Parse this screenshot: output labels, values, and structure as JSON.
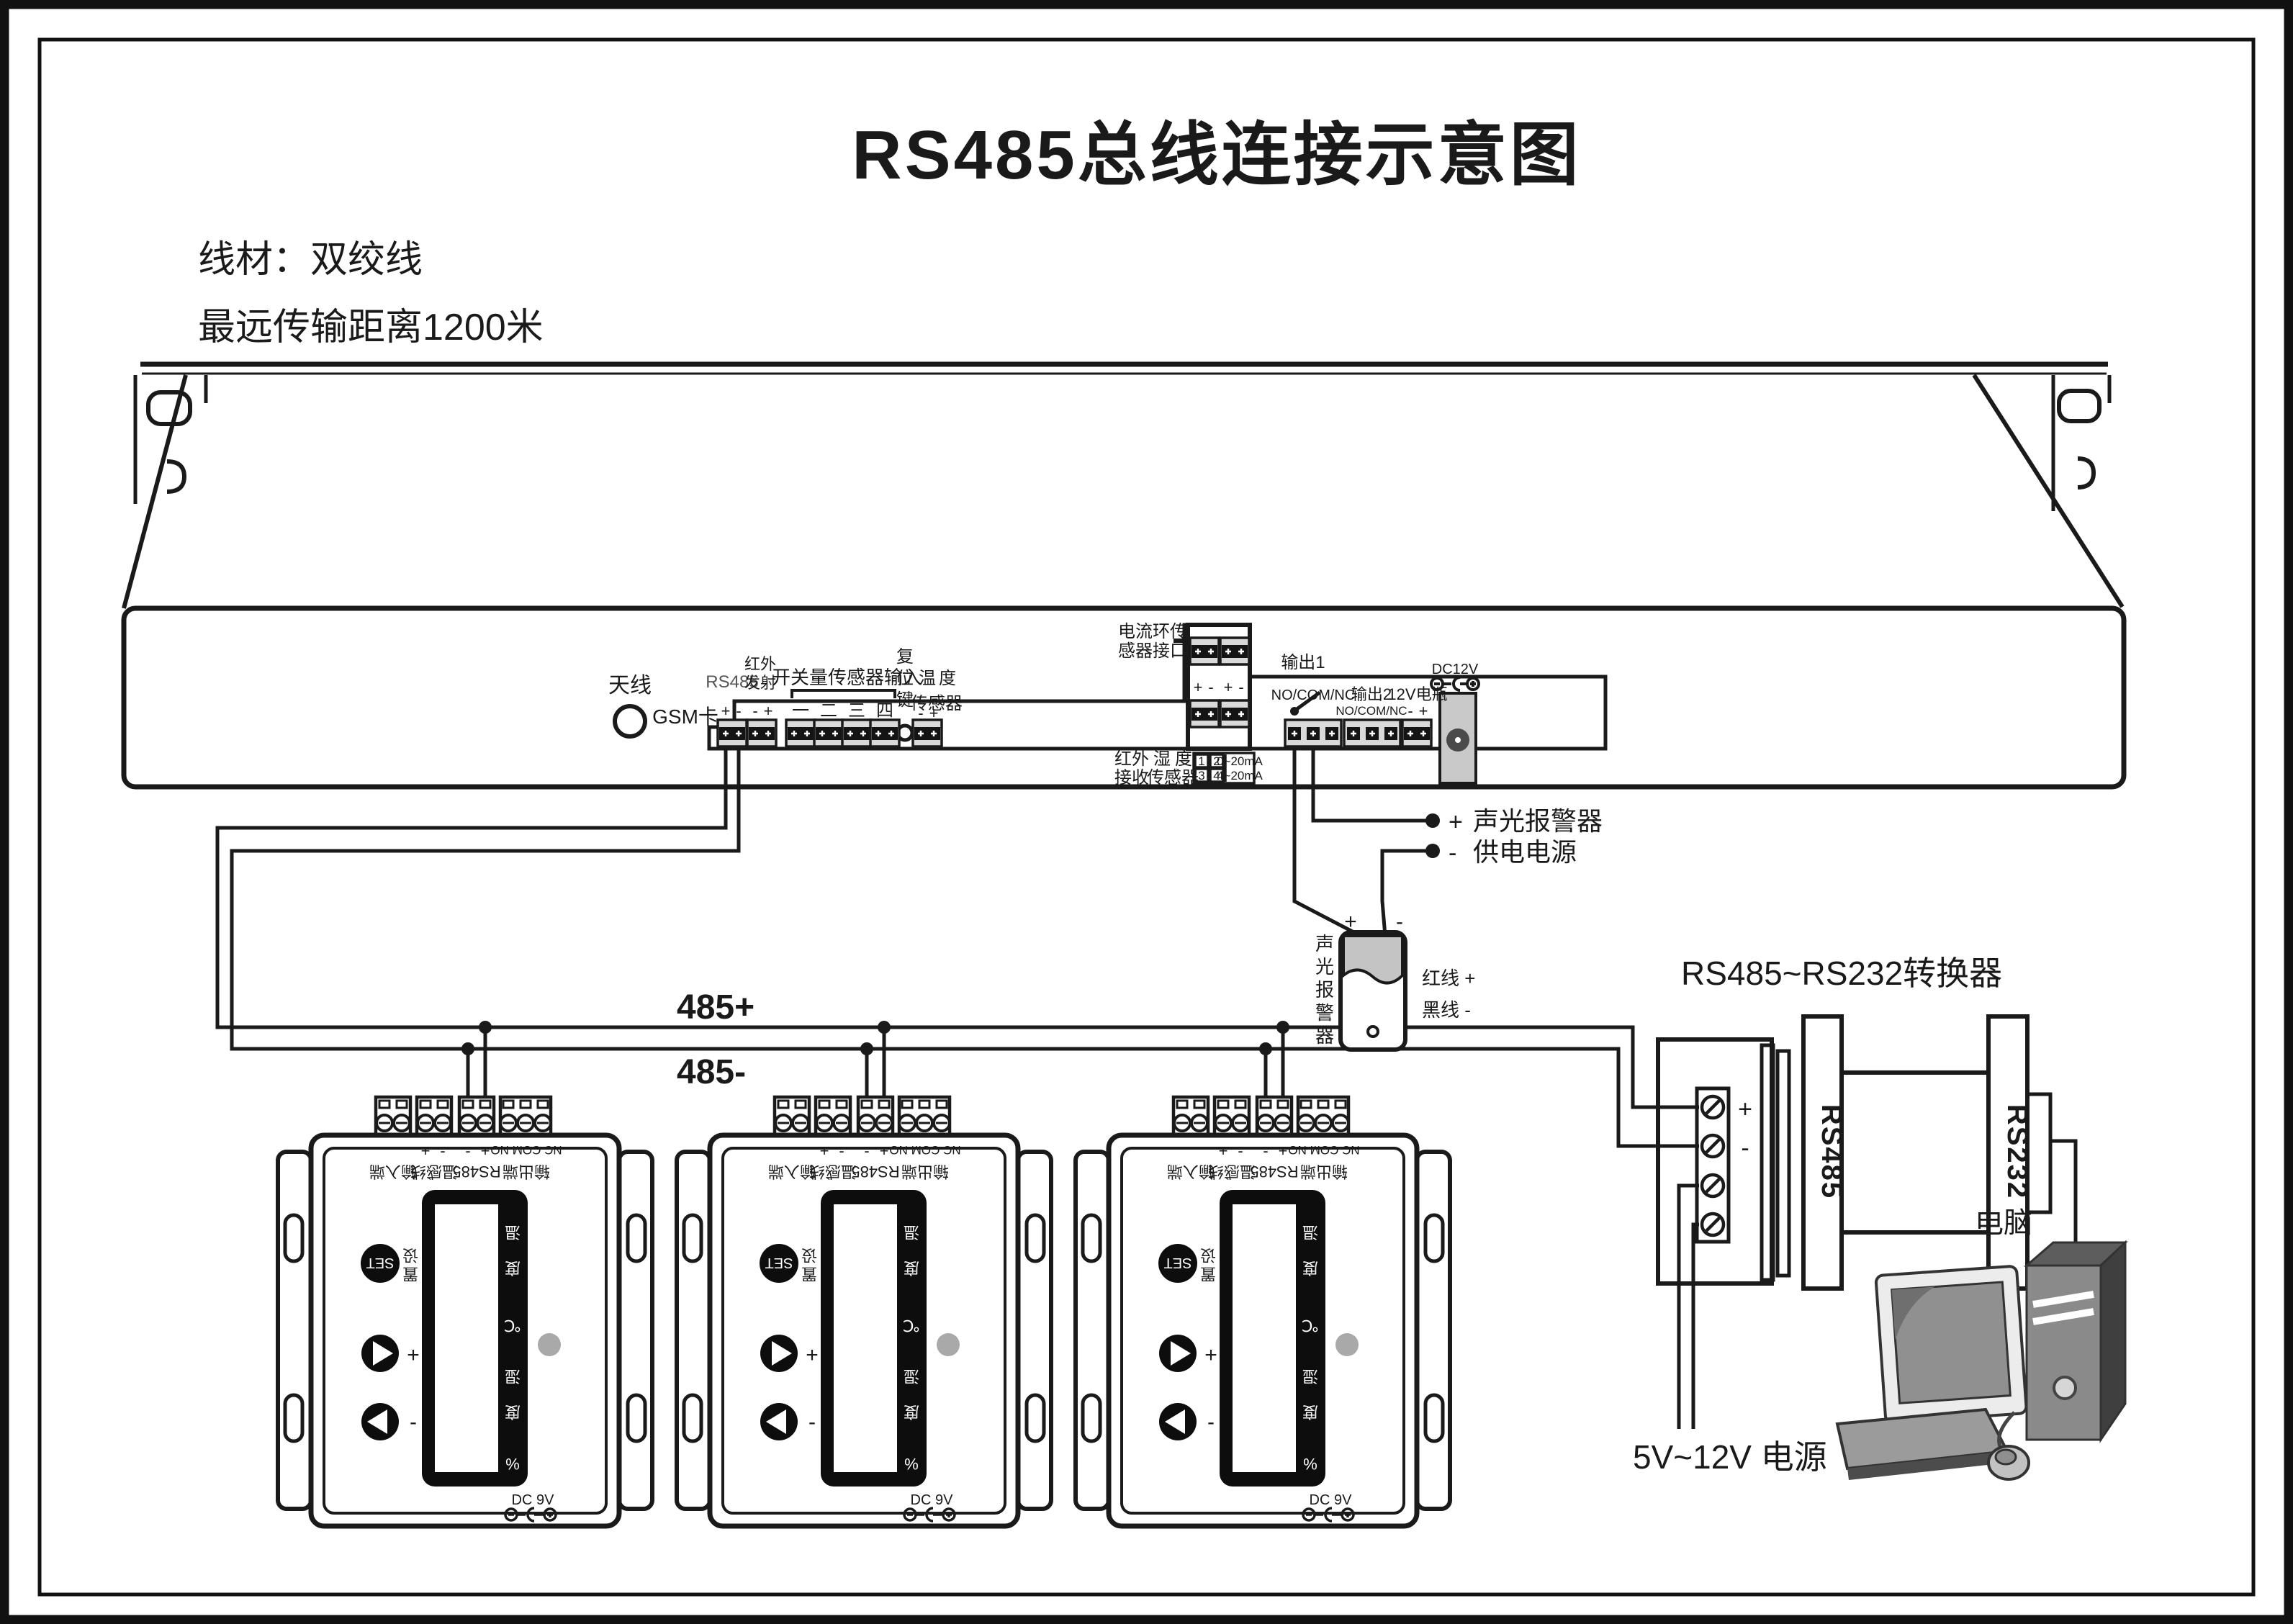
{
  "title": "RS485总线连接示意图",
  "notes": {
    "l1": "线材：双绞线",
    "l2": "最远传输距离1200米"
  },
  "rack": {
    "antenna": "天线",
    "gsm": "GSM卡",
    "rs485": "RS485",
    "ir_tx1": "红外",
    "ir_tx2": "发射",
    "plus": "+",
    "minus": "-",
    "di_label": "开关量传感器输入",
    "di1": "一",
    "di2": "二",
    "di3": "三",
    "di4": "四",
    "rst1": "复",
    "rst2": "位",
    "rst3": "键",
    "t1": "温",
    "t2": "度",
    "t3": "传感器",
    "cl1": "电流环传",
    "cl2": "感器接口",
    "out1": "输出1",
    "nocomnc": "NO/COM/NC",
    "out2": "输出2",
    "bat": "12V电瓶",
    "dc12": "DC12V",
    "ir_rx1": "红外",
    "ir_rx2": "接收",
    "hum1": "湿",
    "hum2": "度",
    "hum3": "传感器",
    "tb1": "1",
    "tb2": "2",
    "tb3": "3",
    "tb4": "4",
    "tr1": "0~20mA",
    "tr2": "4~20mA"
  },
  "bus": {
    "p": "485+",
    "m": "485-"
  },
  "alarm": {
    "a1": "声光报警器",
    "a2": "供电电源",
    "plus": "+",
    "minus": "-",
    "v1": "声",
    "v2": "光",
    "v3": "报",
    "v4": "警",
    "v5": "器",
    "red": "红线 +",
    "black": "黑线 -"
  },
  "conv": {
    "label": "RS485~RS232转换器",
    "rs485": "RS485",
    "rs232": "RS232",
    "plus": "+",
    "minus": "-",
    "power": "5V~12V 电源"
  },
  "pc": {
    "label": "电脑"
  },
  "ctrl": {
    "plus": "+",
    "minus": "-",
    "ncm": "NC COM NO",
    "g1": "输入端",
    "g2": "温感线",
    "g3": "RS485",
    "g4": "输出端",
    "set": "SET",
    "set_cn1": "设",
    "set_cn2": "置",
    "d1": "温",
    "d2": "度",
    "d3": "℃",
    "d4": "湿",
    "d5": "度",
    "d6": "%",
    "dc": "DC 9V"
  }
}
